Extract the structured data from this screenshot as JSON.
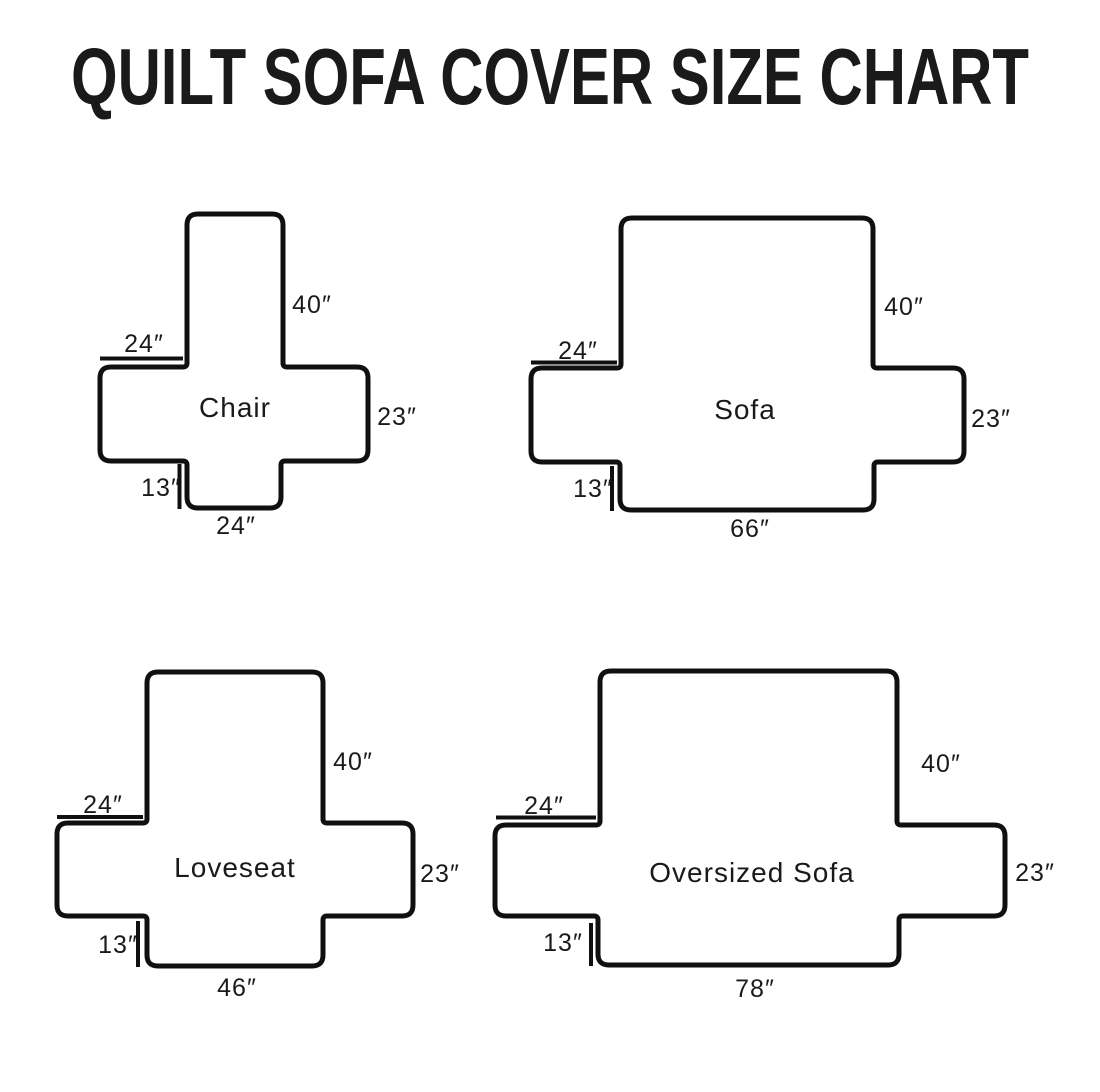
{
  "title": "QUILT SOFA COVER SIZE CHART",
  "colors": {
    "line": "#101010",
    "text": "#1a1a1a",
    "background": "#ffffff"
  },
  "diagrams": [
    {
      "name": "Chair",
      "back_height": "40″",
      "arm_top_width": "24″",
      "arm_side_height": "23″",
      "skirt_height": "13″",
      "bottom_width": "24″"
    },
    {
      "name": "Sofa",
      "back_height": "40″",
      "arm_top_width": "24″",
      "arm_side_height": "23″",
      "skirt_height": "13″",
      "bottom_width": "66″"
    },
    {
      "name": "Loveseat",
      "back_height": "40″",
      "arm_top_width": "24″",
      "arm_side_height": "23″",
      "skirt_height": "13″",
      "bottom_width": "46″"
    },
    {
      "name": "Oversized Sofa",
      "back_height": "40″",
      "arm_top_width": "24″",
      "arm_side_height": "23″",
      "skirt_height": "13″",
      "bottom_width": "78″"
    }
  ]
}
